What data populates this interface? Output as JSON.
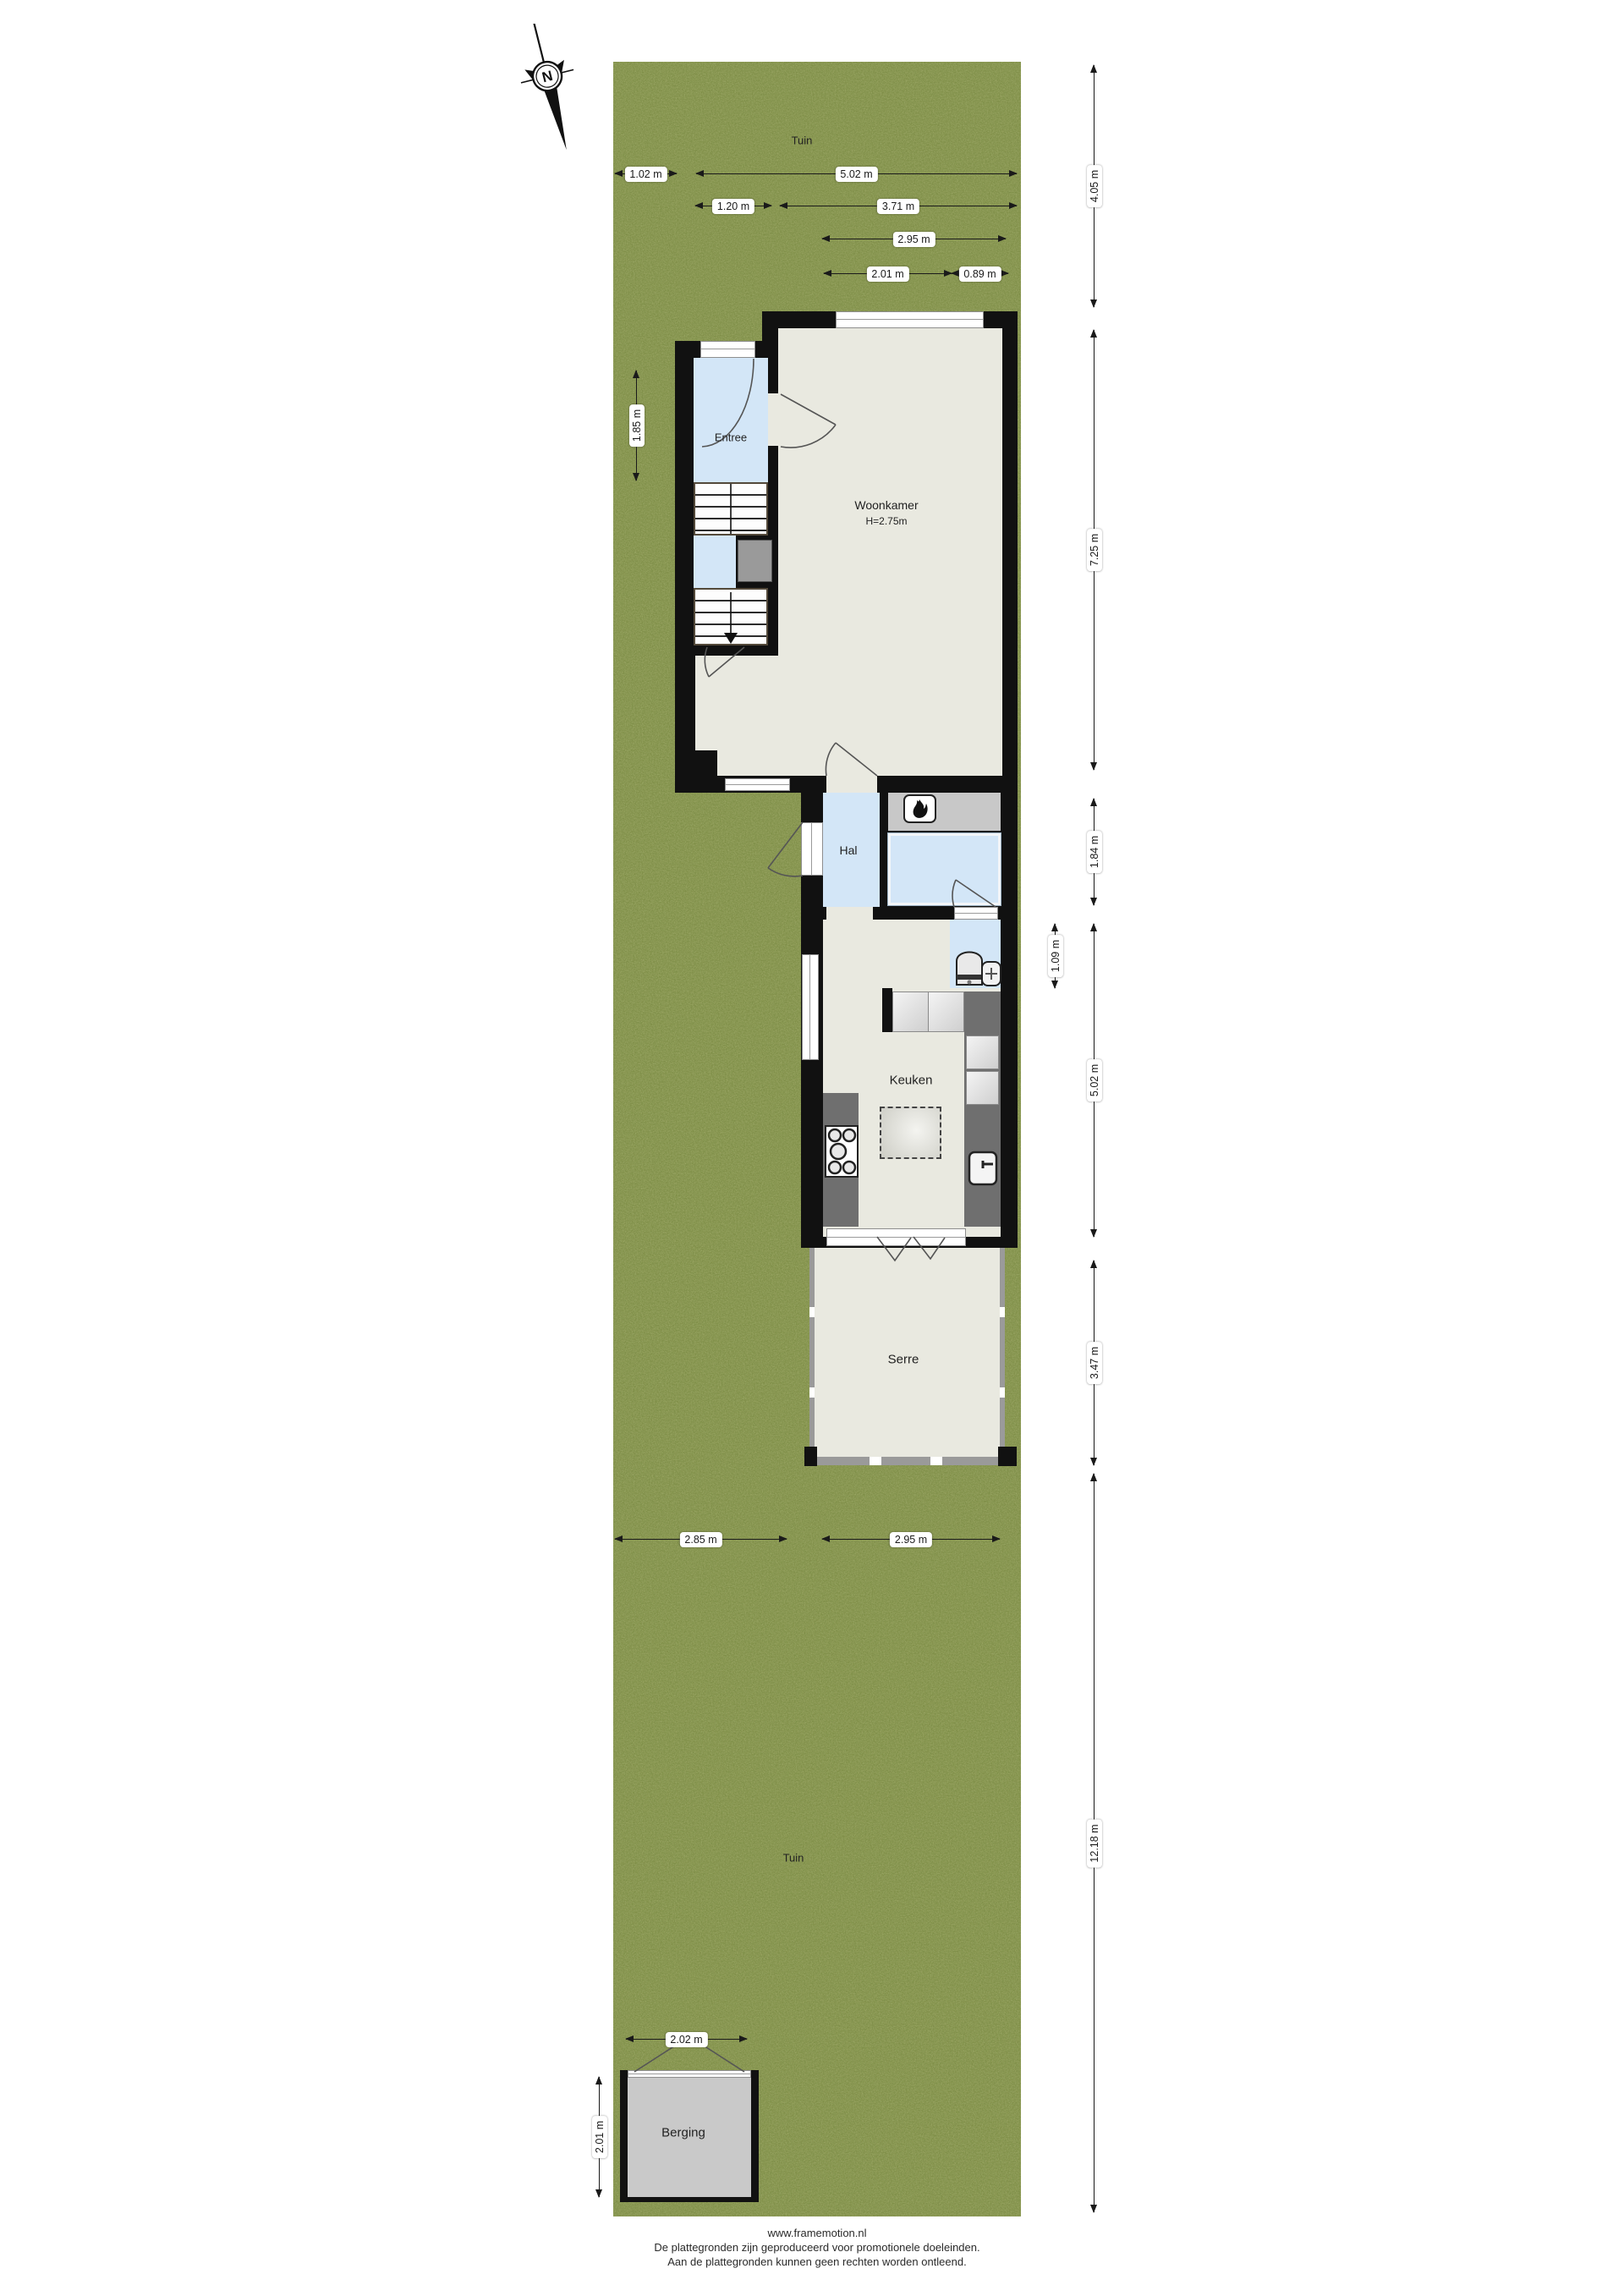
{
  "garden": {
    "label_top": "Tuin",
    "label_bottom": "Tuin"
  },
  "compass": {
    "north": "N"
  },
  "rooms": {
    "entree": "Entree",
    "woonkamer": "Woonkamer",
    "woonkamer_height": "H=2.75m",
    "hal": "Hal",
    "keuken": "Keuken",
    "serre": "Serre",
    "berging": "Berging"
  },
  "dimensions": {
    "garden_left_width": "1.02 m",
    "house_width_total": "5.02 m",
    "entree_width": "1.20 m",
    "woonkamer_width": "3.71 m",
    "mid_width": "2.95 m",
    "keuken_width": "2.01 m",
    "toilet_width": "0.89 m",
    "entree_depth": "1.85 m",
    "front_garden_depth": "4.05 m",
    "woonkamer_depth": "7.25 m",
    "hal_depth": "1.84 m",
    "toilet_depth": "1.09 m",
    "keuken_depth": "5.02 m",
    "serre_depth": "3.47 m",
    "back_garden_depth": "12.18 m",
    "garden_bottom_left": "2.85 m",
    "garden_bottom_right": "2.95 m",
    "berging_width": "2.02 m",
    "berging_depth": "2.01 m"
  },
  "footer": {
    "website": "www.framemotion.nl",
    "line1": "De plattegronden zijn geproduceerd voor promotionele doeleinden.",
    "line2": "Aan de plattegronden kunnen geen rechten worden ontleend."
  },
  "colors": {
    "grass": "#7d8d46",
    "wall": "#111111",
    "floor": "#e9e9e0",
    "wet_room": "#d3e6f7",
    "counter": "#6f6f6f",
    "fireplace_strip": "#c8c8c8",
    "berging_floor": "#c9c9c9"
  }
}
